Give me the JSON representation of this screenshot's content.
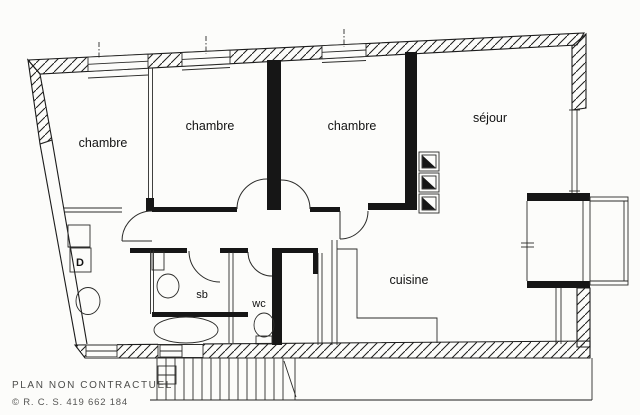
{
  "colors": {
    "ink": "#1c1c1c",
    "paper": "#fcfcfa",
    "muted": "#4c4c4a"
  },
  "plan": {
    "rooms": [
      {
        "id": "chambre-1",
        "label": "chambre"
      },
      {
        "id": "chambre-2",
        "label": "chambre"
      },
      {
        "id": "chambre-3",
        "label": "chambre"
      },
      {
        "id": "sejour",
        "label": "séjour"
      },
      {
        "id": "cuisine",
        "label": "cuisine"
      },
      {
        "id": "salle-de-bains",
        "label": "sb"
      },
      {
        "id": "wc",
        "label": "wc"
      },
      {
        "id": "dressing",
        "label": "D"
      }
    ]
  },
  "footer": {
    "disclaimer": "PLAN NON CONTRACTUEL",
    "registration": "© R. C. S. 419 662 184"
  }
}
